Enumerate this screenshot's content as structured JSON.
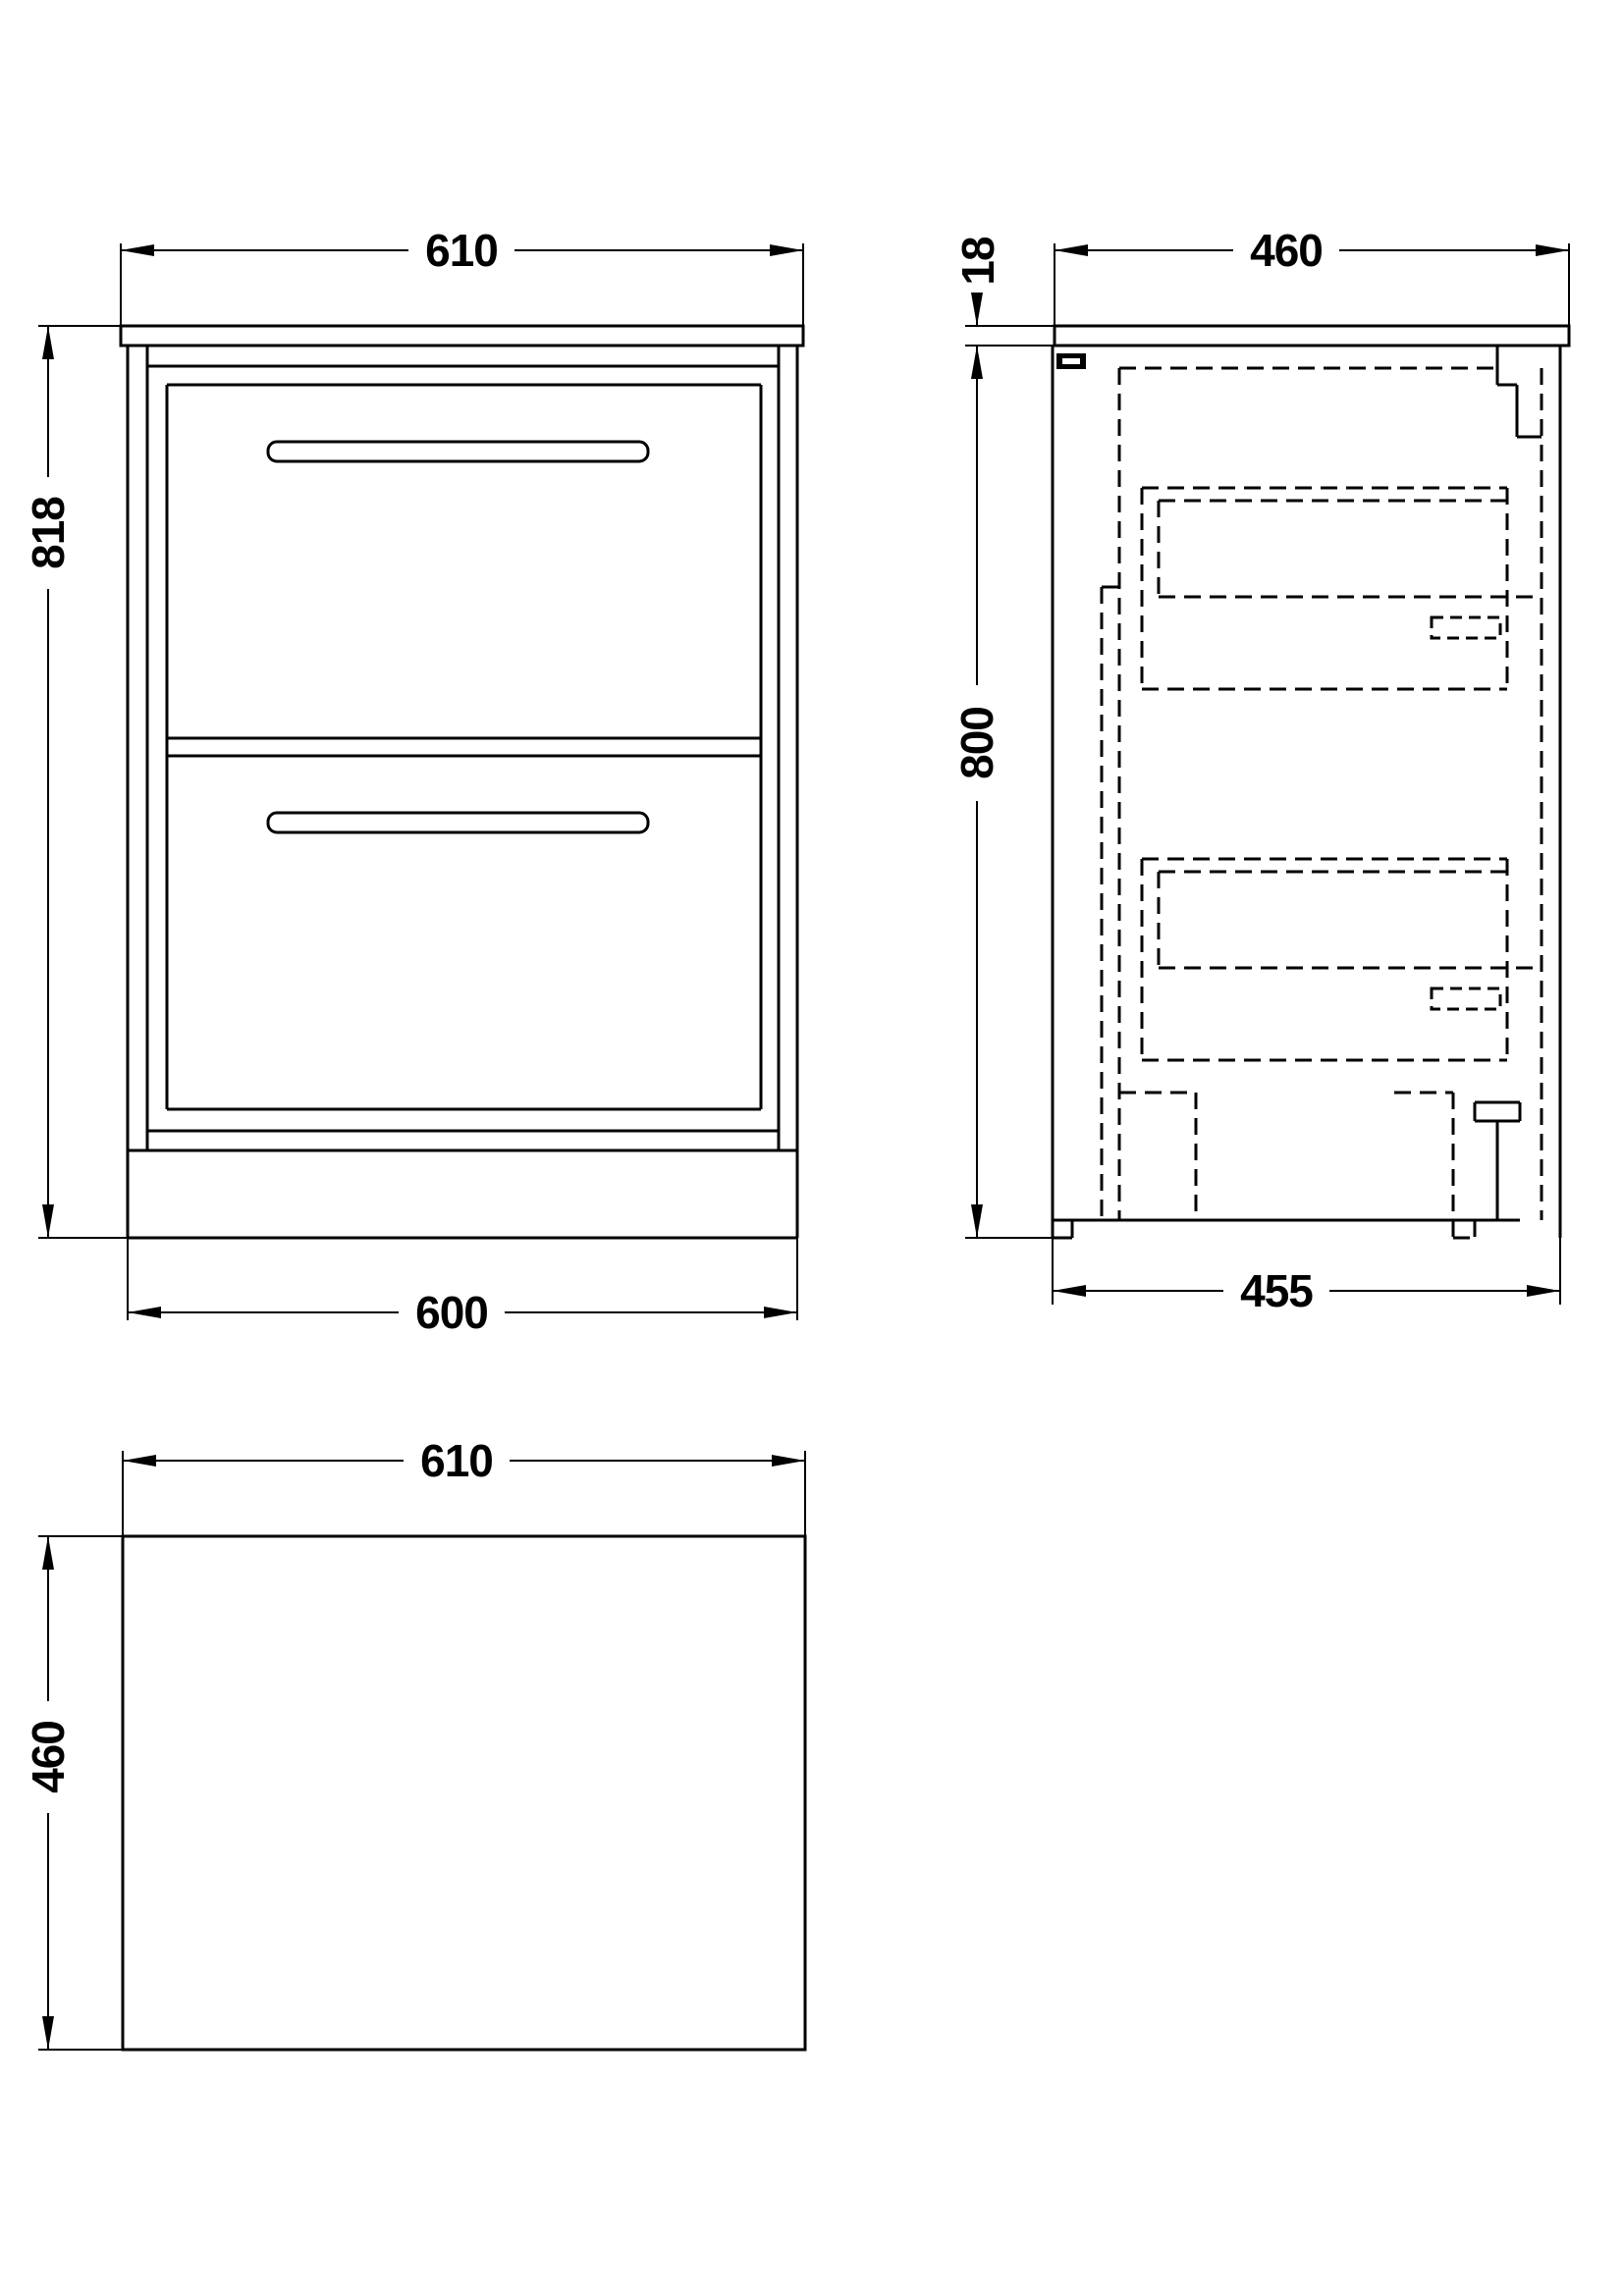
{
  "dimensions": {
    "front_view": {
      "top_width": "610",
      "height": "818",
      "bottom_width": "600"
    },
    "side_view": {
      "top_depth": "460",
      "worktop_thickness": "18",
      "height": "800",
      "bottom_depth": "455"
    },
    "plan_view": {
      "width": "610",
      "depth": "460"
    }
  },
  "colors": {
    "line": "#000000",
    "background": "#ffffff"
  }
}
